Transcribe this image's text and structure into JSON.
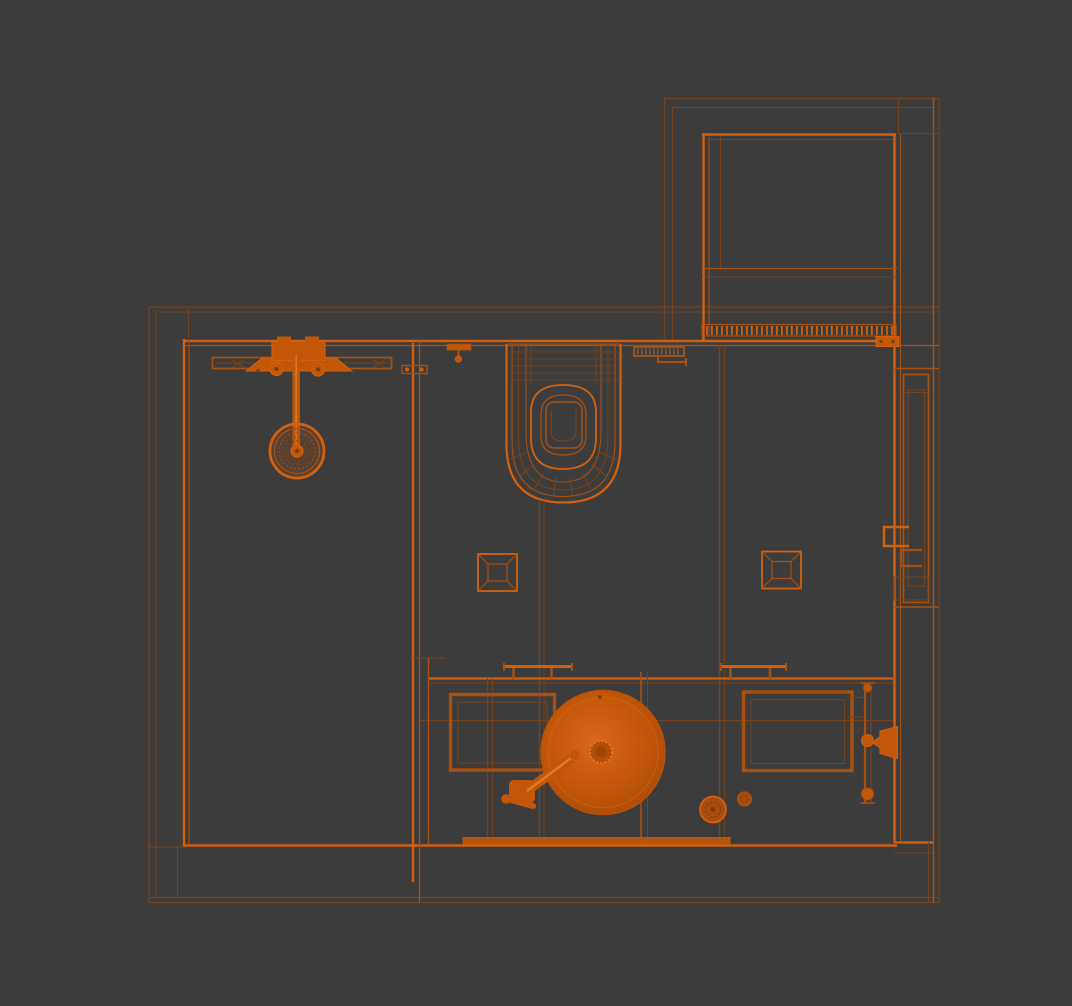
{
  "viewport": {
    "description": "Orthographic top view wireframe of a 3D bathroom model",
    "view_mode": "wireframe",
    "camera": "top"
  },
  "palette": {
    "bg": "#3d3c3c",
    "line_bright": "#d2600f",
    "line_mid": "#a8500f",
    "line_dim": "#78421a",
    "fill_solid": "#c25708",
    "fill_deep": "#7a3c10",
    "fill_accessory": "#a84c10",
    "sink_center": "#d8691c",
    "sink_mid": "#c45708",
    "sink_edge": "#ad4b06",
    "highlight": "#e07a28"
  },
  "objects": {
    "rooms": [
      "main-bathroom",
      "upper-alcove"
    ],
    "fixtures": [
      "rain-shower-head",
      "shower-arm",
      "shower-mixer-valve",
      "shower-shelf",
      "glass-partition",
      "wall-hook",
      "partition-clamp",
      "wall-hung-toilet",
      "toilet-flush-plate",
      "supply-pipe",
      "floor-drain-left",
      "floor-drain-right",
      "linear-grate",
      "vanity-counter",
      "vessel-sink",
      "sink-drain",
      "sink-faucet",
      "towel-bar-left",
      "towel-bar-right",
      "base-cabinet-left",
      "base-cabinet-right",
      "wall-spout",
      "vertical-rail",
      "round-tray",
      "cup",
      "entry-door",
      "door-pull-handles",
      "threshold-strip"
    ]
  }
}
